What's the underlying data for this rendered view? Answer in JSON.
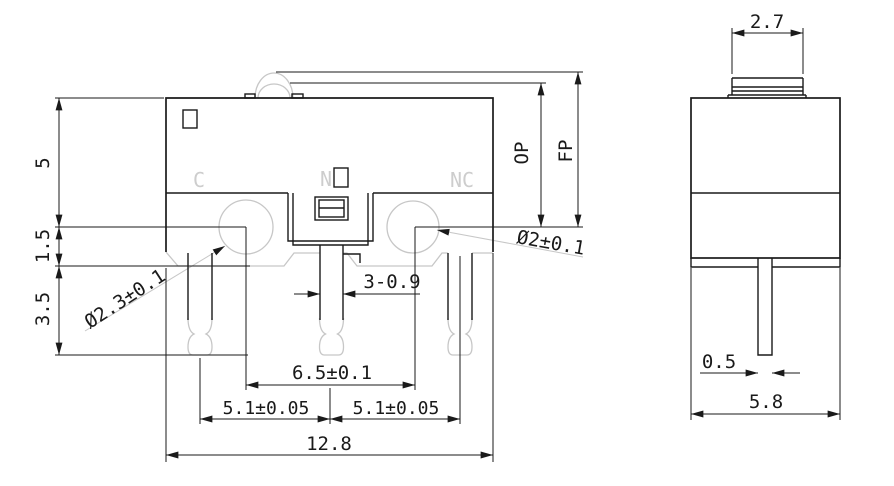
{
  "drawing_type": "micro-switch dimensional drawing",
  "colors": {
    "line": "#1a1a1a",
    "auxiliary": "#c7c7c7",
    "background": "#ffffff"
  },
  "front_view": {
    "terminal_labels": {
      "c": "C",
      "n": "N",
      "nc": "NC"
    },
    "dimensions": {
      "height_body": "5",
      "height_base": "1.5",
      "height_terminal": "3.5",
      "hole_left_dia": "Ø2.3±0.1",
      "hole_right_dia": "Ø2±0.1",
      "terminal_width": "3-0.9",
      "hole_spacing": "6.5±0.1",
      "terminal_pitch_left": "5.1±0.05",
      "terminal_pitch_right": "5.1±0.05",
      "body_width": "12.8",
      "operating_position": "OP",
      "free_position": "FP"
    }
  },
  "side_view": {
    "dimensions": {
      "button_width": "2.7",
      "terminal_thickness": "0.5",
      "body_depth": "5.8"
    }
  }
}
